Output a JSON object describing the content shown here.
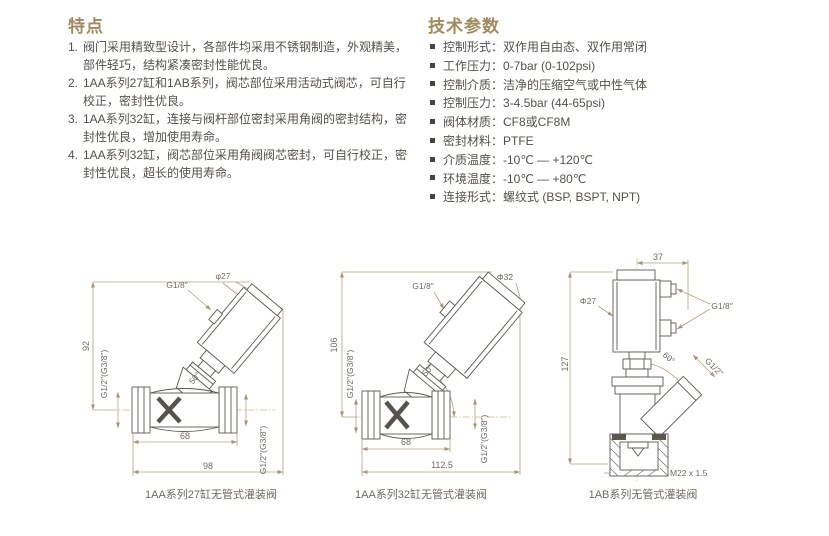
{
  "features": {
    "title": "特点",
    "items": [
      {
        "num": "1.",
        "text": "阀门采用精致型设计，各部件均采用不锈钢制造，外观精美，部件轻巧，结构紧凑密封性能优良。"
      },
      {
        "num": "2.",
        "text": "1AA系列27缸和1AB系列，阀芯部位采用活动式阀芯，可自行校正，密封性优良。"
      },
      {
        "num": "3.",
        "text": "1AA系列32缸，连接与阀杆部位密封采用角阀的密封结构，密封性优良，增加使用寿命。"
      },
      {
        "num": "4.",
        "text": "1AA系列32缸，阀芯部位采用角阀阀芯密封，可自行校正，密封性优良，超长的使用寿命。"
      }
    ]
  },
  "specs": {
    "title": "技术参数",
    "items": [
      {
        "label": "控制形式：",
        "value": "双作用自由态、双作用常闭"
      },
      {
        "label": "工作压力：",
        "value": "0-7bar (0-102psi)"
      },
      {
        "label": "控制介质：",
        "value": "洁净的压缩空气或中性气体"
      },
      {
        "label": "控制压力：",
        "value": "3-4.5bar (44-65psi)"
      },
      {
        "label": "阀体材质：",
        "value": "CF8或CF8M"
      },
      {
        "label": "密封材料：",
        "value": "PTFE"
      },
      {
        "label": "介质温度：",
        "value": "-10℃ — +120℃"
      },
      {
        "label": "环境温度：",
        "value": "-10℃ — +80℃"
      },
      {
        "label": "连接形式：",
        "value": "螺纹式 (BSP, BSPT, NPT)"
      }
    ]
  },
  "drawings": [
    {
      "caption": "1AA系列27缸无管式灌装阀",
      "labels": {
        "height": "92",
        "pilot_port": "G1/8\"",
        "actuator_diameter": "φ27",
        "inlet_port": "G1/2\"(G3/8\")",
        "angle": "50°",
        "body_length": "68",
        "overall_length": "98",
        "outlet_port": "G1/2\"(G3/8\")"
      }
    },
    {
      "caption": "1AA系列32缸无管式灌装阀",
      "labels": {
        "height": "106",
        "pilot_port": "G1/8\"",
        "actuator_diameter": "Φ32",
        "inlet_port": "G1/2\"(G3/8\")",
        "angle": "50°",
        "body_length": "68",
        "overall_length": "112.5",
        "outlet_port": "G1/2\"(G3/8\")"
      }
    },
    {
      "caption": "1AB系列无管式灌装阀",
      "labels": {
        "top_width": "37",
        "actuator_diameter": "Φ27",
        "pilot_ports": "G1/8\"",
        "height": "127",
        "angle": "60°",
        "outlet_port": "G1/2\"",
        "bottom_thread": "M22 x 1.5"
      }
    }
  ],
  "colors": {
    "heading": "#a08a60",
    "body_text": "#53514a",
    "dimension_line": "#b3a084",
    "drawing_outline": "#5b5950",
    "label_text": "#6e6a61"
  }
}
